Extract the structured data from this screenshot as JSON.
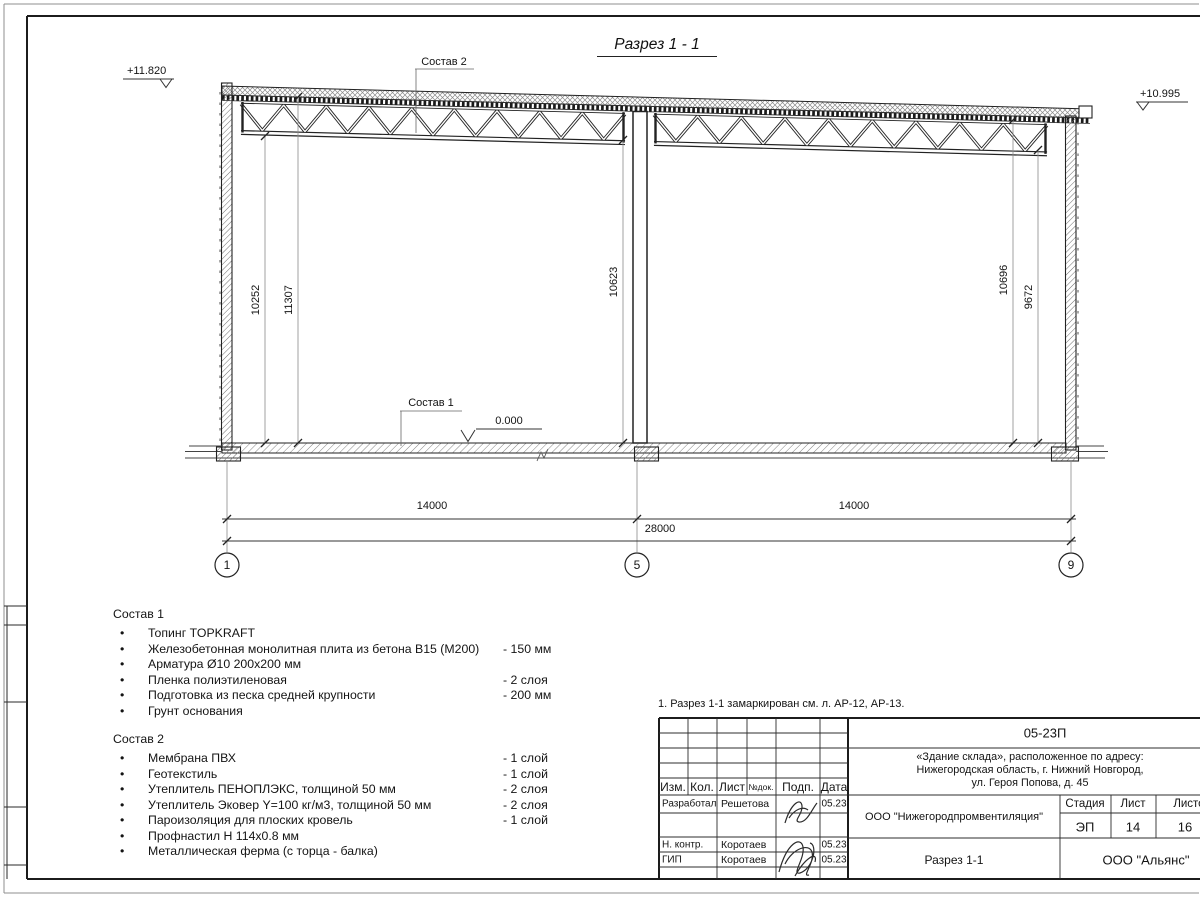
{
  "section": {
    "title": "Разрез 1 - 1",
    "elev_left": "+11.820",
    "elev_right": "+10.995",
    "elev_zero": "0.000",
    "callout_roof": "Состав 2",
    "callout_floor": "Состав 1",
    "dim_left_clear": "10252",
    "dim_left_total": "11307",
    "dim_mid": "10623",
    "dim_right_total": "10696",
    "dim_right_clear": "9672",
    "dim_span_left": "14000",
    "dim_span_right": "14000",
    "dim_total": "28000",
    "axis_1": "1",
    "axis_5": "5",
    "axis_9": "9"
  },
  "legend": {
    "bullet": "•",
    "sostav1": {
      "title": "Состав 1",
      "items": [
        {
          "t": "Топинг TOPKRAFT",
          "v": ""
        },
        {
          "t": "Железобетонная монолитная плита из бетона В15 (М200)",
          "v": "-  150 мм"
        },
        {
          "t": "Арматура Ø10 200х200 мм",
          "v": ""
        },
        {
          "t": "Пленка полиэтиленовая",
          "v": "-  2 слоя"
        },
        {
          "t": "Подготовка из песка средней крупности",
          "v": "- 200 мм"
        },
        {
          "t": "Грунт основания",
          "v": ""
        }
      ]
    },
    "sostav2": {
      "title": "Состав 2",
      "items": [
        {
          "t": "Мембрана ПВХ",
          "v": "- 1 слой"
        },
        {
          "t": "Геотекстиль",
          "v": "- 1 слой"
        },
        {
          "t": "Утеплитель ПЕНОПЛЭКС, толщиной 50 мм",
          "v": "- 2 слоя"
        },
        {
          "t": "Утеплитель Эковер Y=100 кг/м3, толщиной 50 мм",
          "v": "- 2 слоя"
        },
        {
          "t": "Пароизоляция для плоских кровель",
          "v": "- 1 слой"
        },
        {
          "t": "Профнастил Н 114х0.8 мм",
          "v": ""
        },
        {
          "t": "Металлическая ферма (с торца - балка)",
          "v": ""
        }
      ]
    }
  },
  "note": "1. Разрез 1-1 замаркирован см. л. АР-12, АР-13.",
  "stamp": {
    "code": "05-23П",
    "address_line1": "«Здание склада», расположенное по адресу:",
    "address_line2": "Нижегородская область, г. Нижний Новгород,",
    "address_line3": "ул. Героя Попова, д. 45",
    "col_izm": "Изм.",
    "col_kol": "Кол.",
    "col_list": "Лист",
    "col_ndok": "№док.",
    "col_podp": "Подп.",
    "col_data": "Дата",
    "rows": [
      {
        "role": "Разработал",
        "name": "Решетова",
        "date": "05.23"
      },
      {
        "role": "Н. контр.",
        "name": "Коротаев",
        "date": "05.23"
      },
      {
        "role": "ГИП",
        "name": "Коротаев",
        "date": "05.23"
      }
    ],
    "org": "ООО \"Нижегородпромвентиляция\"",
    "stage_label": "Стадия",
    "sheet_label": "Лист",
    "sheets_label": "Листов",
    "stage": "ЭП",
    "sheet_no": "14",
    "sheets_total": "16",
    "drawing_name": "Разрез 1-1",
    "company": "ООО \"Альянс\""
  }
}
